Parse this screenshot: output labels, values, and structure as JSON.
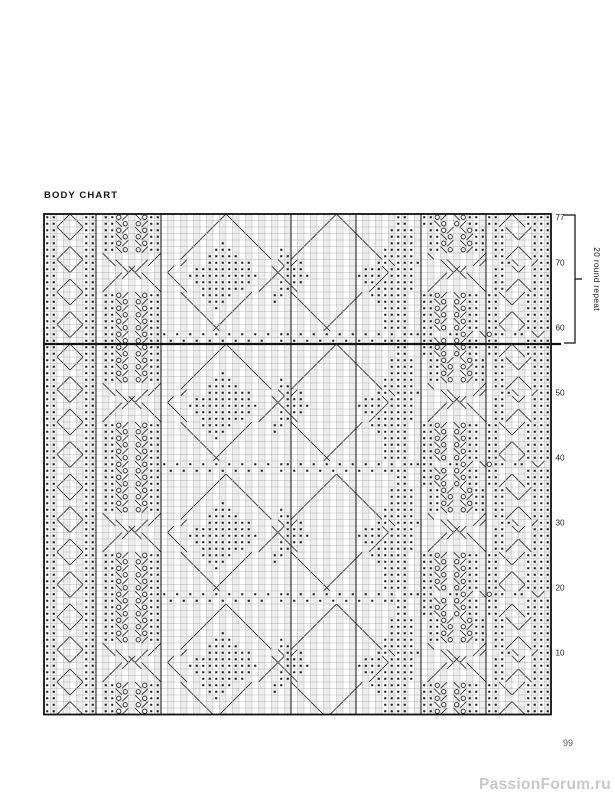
{
  "page": {
    "title": "BODY CHART",
    "page_number": "99",
    "watermark": "PassionForum.ru"
  },
  "chart": {
    "rows": 77,
    "cols": 78,
    "cell": 6.5,
    "left": 44,
    "top": 214,
    "row_labels": [
      77,
      70,
      60,
      50,
      40,
      30,
      20,
      10
    ],
    "repeat": {
      "label": "20 round repeat",
      "rows": 20,
      "from_row": 58,
      "to_row": 77
    },
    "heavy_cols": [
      8,
      18,
      38,
      48,
      58,
      68
    ],
    "symbols_legend": {
      ".": "purl-dot",
      " ": "knit",
      "o": "yarn-over",
      "/": "right-leaning-line",
      "\\": "left-leaning-line",
      "x": "crossed-lines"
    },
    "colors": {
      "line": "#1c1c1c",
      "grid": "#9b9b9b",
      "heavy": "#111111",
      "shade": "#ededed",
      "paper": "#ffffff",
      "label": "#1c1c1c"
    },
    "repeat_rows_top_down": [
      ".. /\\ .. ..o/ \\o..         /\\               /\\        ..  ..o/ \\o.. .. /\\ ....",
      "../  \\.. ..\\o o/..        /  \\             /  \\       ..  ..\\o o/.. ../  \\....",
      "..\\  /.. ..o/ \\o..       /    \\           /    \\     ....  ..o/ \\o.. ..\\  /....",
      ".. \\/ .. ..\\o o/..      /      \\         /      \\    ....  ..\\o o/.. .. \\/ ....",
      "..    .. ..o/ \\o..     /   .    \\       /        \\   ....  ..o/ \\o.. ..    ....",
      ".. /\\ .. ..\\o o/..    /   ...    \\  .  /          \\ .....  ..\\o o/.. .. /\\ ....",
      "../  \\.. \\       /   /   .....    \\ ../            \\.....  \\       / ../  \\....",
      "..\\  /..  \\\\   //    /   .......    \\./.           ..\\....   \\\\   //  ..\\  /....",
      ".. \\/ ..    \\x/    /   .........   \\/...         ...\\....     \\x/    .. \\/ ....",
      "..    ..   // \\\\   \\  ...........  /\\....       ..../....    // \\\\   ..    ....",
      ".. /\\ ..  /     \\   \\  .........  / .\\..         ../.....   /     \\  .. /\\ ....",
      "../  \\.. /       \\   \\  .......  /  ..\\           /......  /       \\ ../  \\....",
      "..\\  /.. ..o/ \\o..   \\  .....  /   .. \\         / ......  ..o/ \\o.. ..\\  /....",
      ".. \\/ .. ..\\o o/..    \\  ...  /    .   \\       /   .....  ..\\o o/.. .. \\/ ....",
      "..    .. ..o/ \\o..     \\  .  /          \\     /     ....  ..o/ \\o.. ..    ....",
      ".. /\\ .. ..\\o o/..      \\   /            \\   /      ....  ..\\o o/.. .. /\\ ....",
      "../  \\.. ..o/ \\o..       \\ /              \\ /       ....  ..o/ \\o.. ../  \\....",
      "..\\  /.. ..\\o o/..        x                x        ....  ..\\o o/.. ..\\  /....",
      ".. \\/ .. ..o/ \\o... . . . . . . . . .. . . . . . . . . .....  ..o/ \\o.. .. \\/ ....",
      "..    .. ..\\o o/.. . . . . . . . .  . . . . . . . . ....  ..\\o o/.. ..    ...."
    ]
  }
}
